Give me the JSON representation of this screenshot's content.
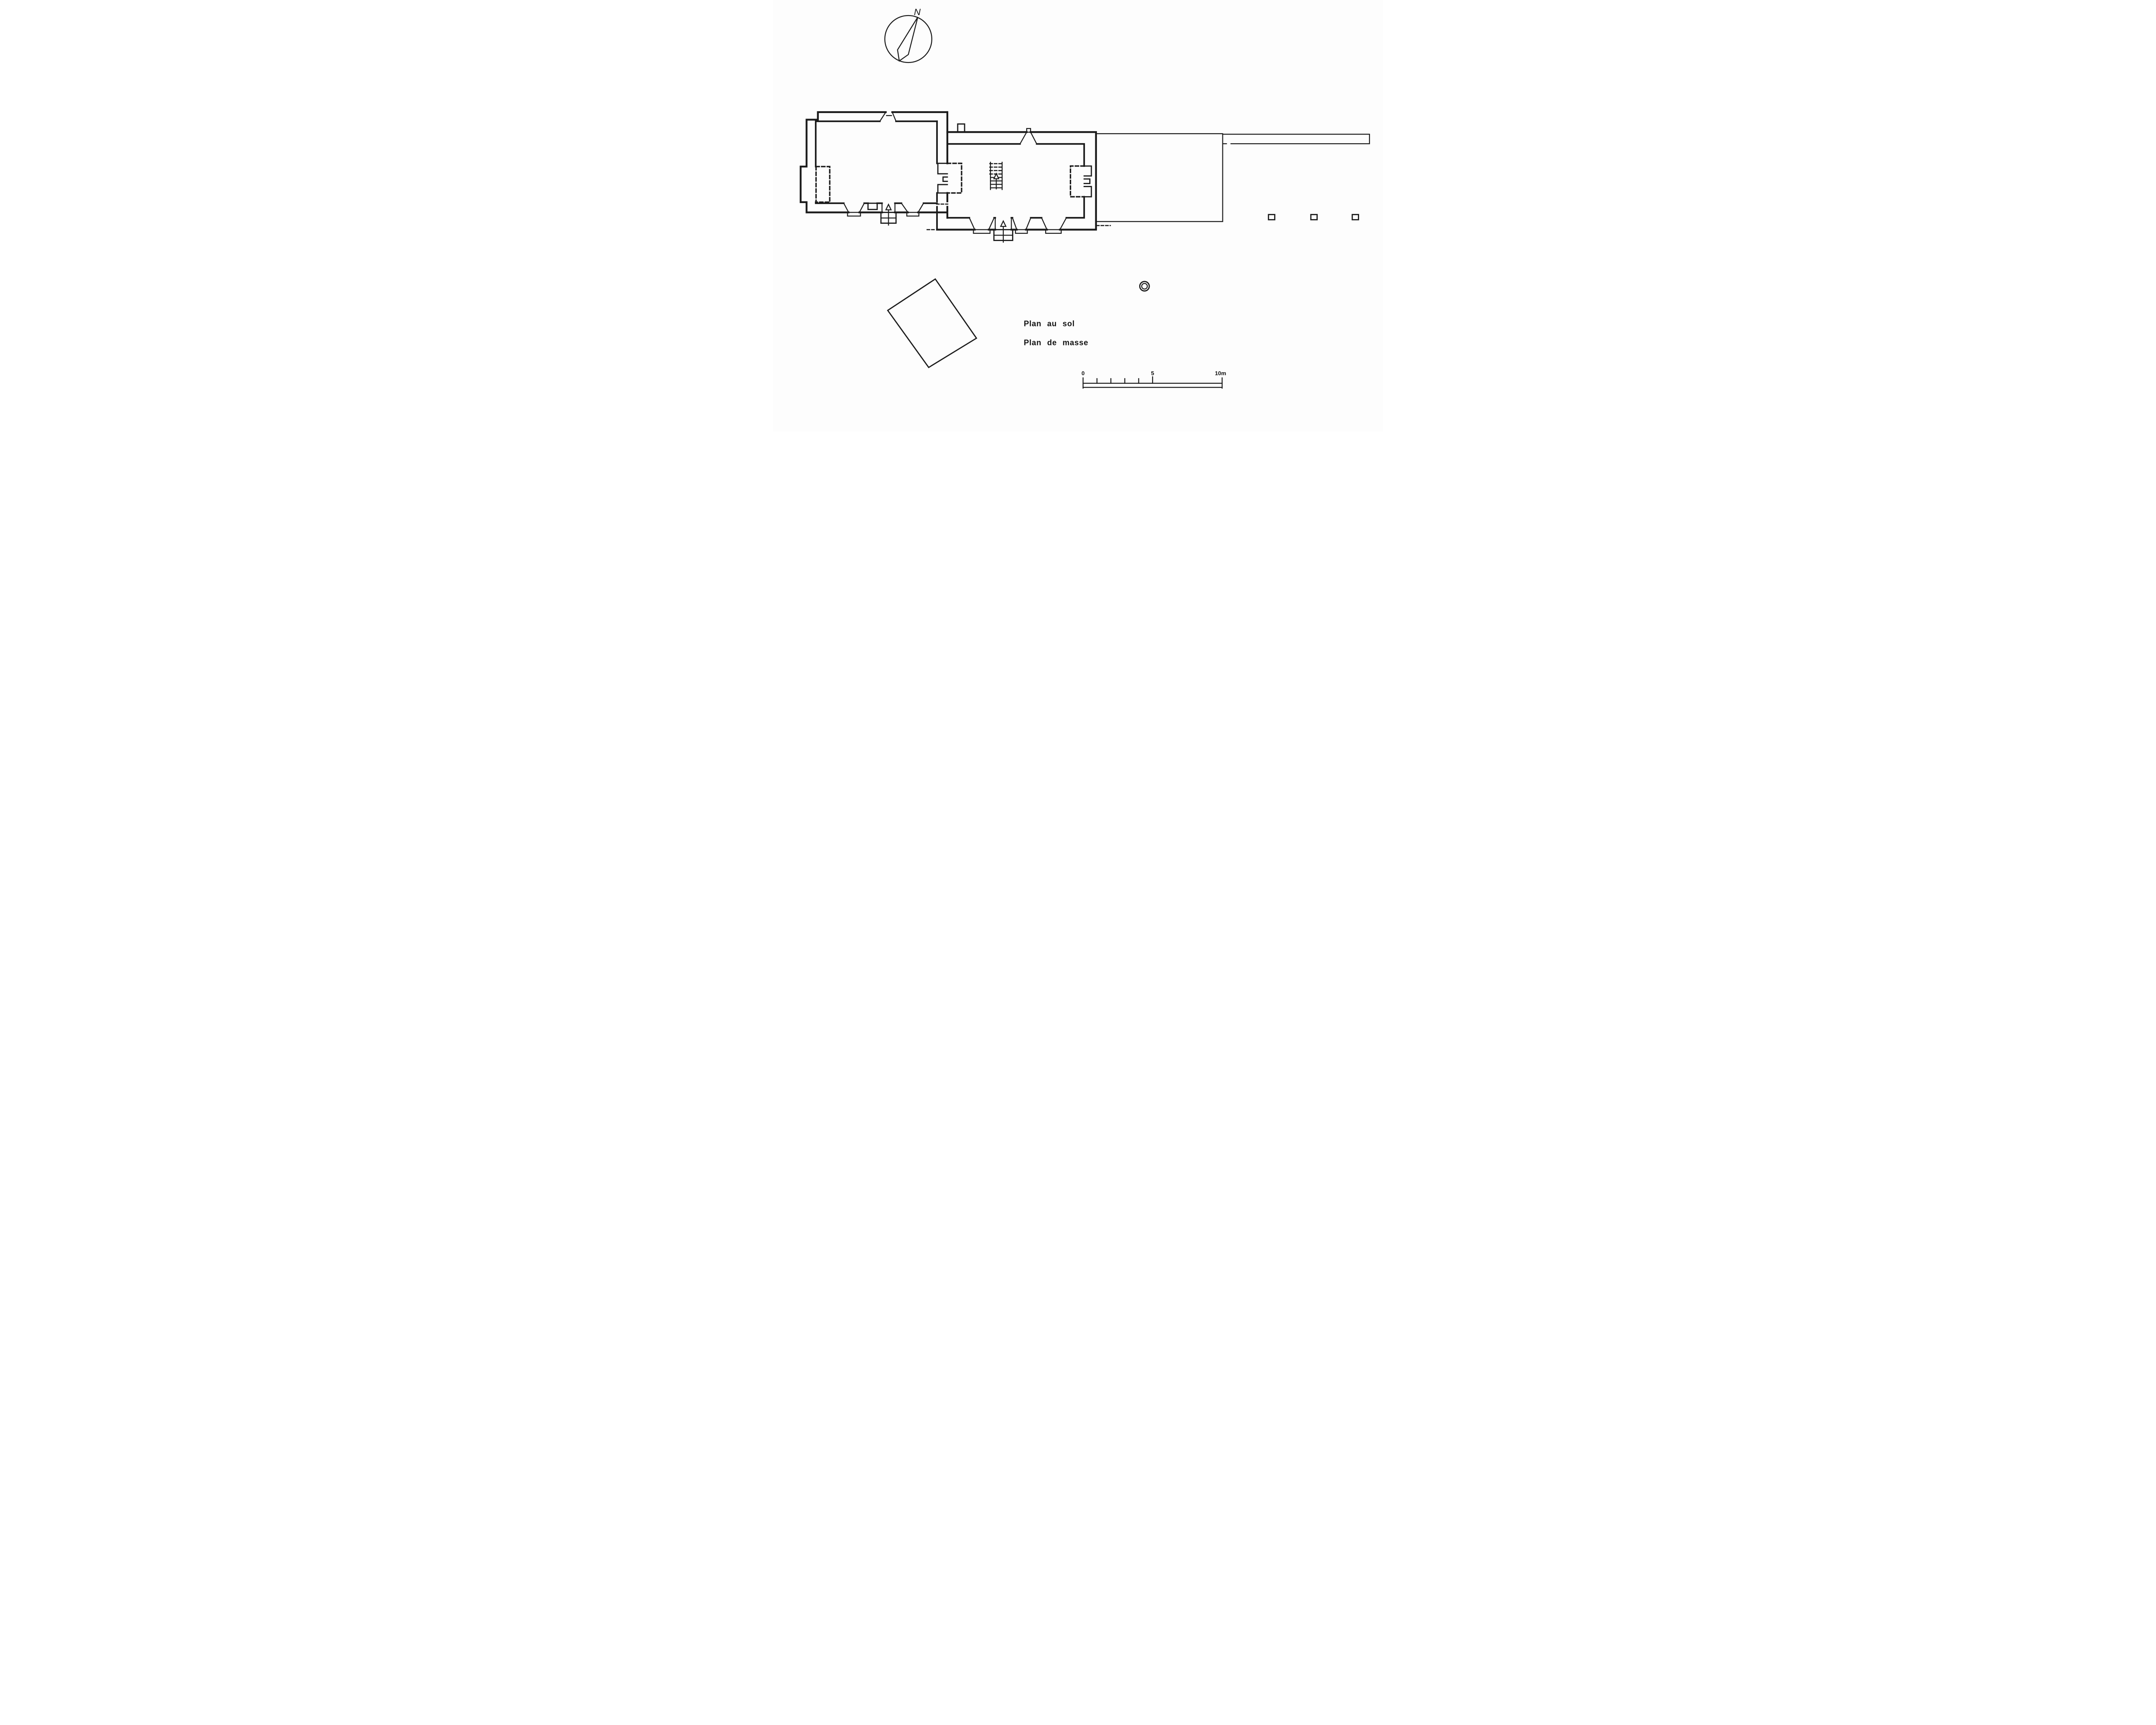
{
  "artwork": {
    "compass_label": "N",
    "title_ground_plan": "Plan au sol",
    "title_site_plan": "Plan de masse"
  },
  "scale_bar": {
    "label_start": "0",
    "label_mid": "5",
    "label_end": "10m",
    "total_meters": 10,
    "minor_tick_values": [
      0,
      1,
      2,
      3,
      4,
      5
    ]
  },
  "colors": {
    "ink": "#1a1a1a",
    "paper": "#fdfdfd"
  },
  "features": [
    "north-compass",
    "ground-floor-plan",
    "west-room",
    "main-room",
    "staircase",
    "fireplace-recesses",
    "entrance-doors",
    "courtyard-enclosure",
    "boundary-wall",
    "pillar-bases",
    "well",
    "outbuilding",
    "scale-bar"
  ]
}
